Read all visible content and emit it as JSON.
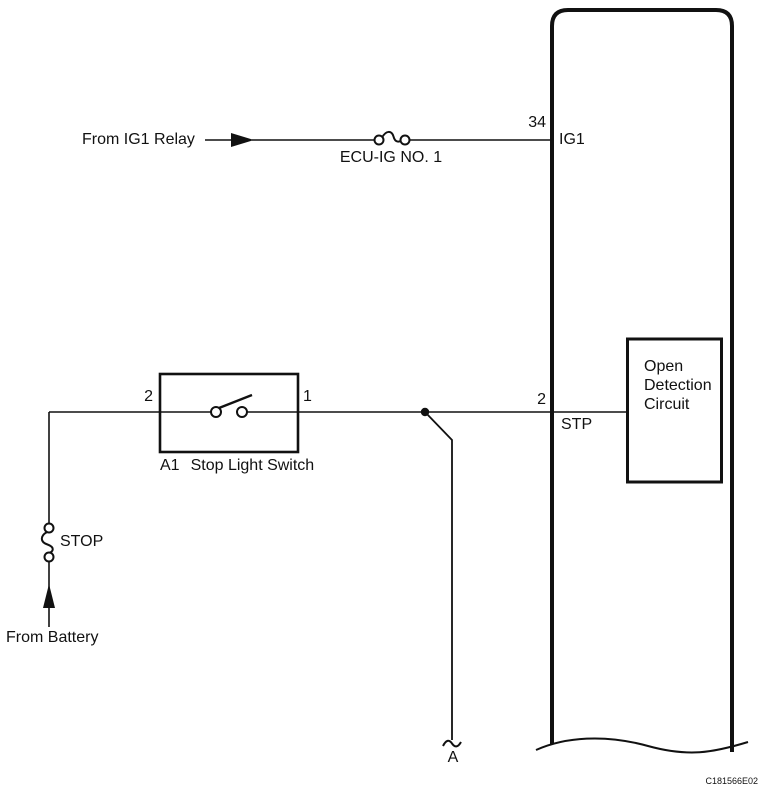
{
  "figure": {
    "code": "C181566E02"
  },
  "ecu": {
    "pin_ig1": {
      "number": "34",
      "name": "IG1"
    },
    "pin_stp": {
      "number": "2",
      "name": "STP"
    },
    "open_detection": {
      "line1": "Open",
      "line2": "Detection",
      "line3": "Circuit"
    }
  },
  "top_branch": {
    "source": "From IG1 Relay",
    "fuse": "ECU-IG NO. 1"
  },
  "switch": {
    "id": "A1",
    "name": "Stop Light Switch",
    "pin_left": "2",
    "pin_right": "1"
  },
  "bottom_branch": {
    "fuse": "STOP",
    "source": "From Battery"
  },
  "break_point": {
    "label": "A"
  },
  "colors": {
    "ink": "#111111",
    "background": "#ffffff"
  }
}
